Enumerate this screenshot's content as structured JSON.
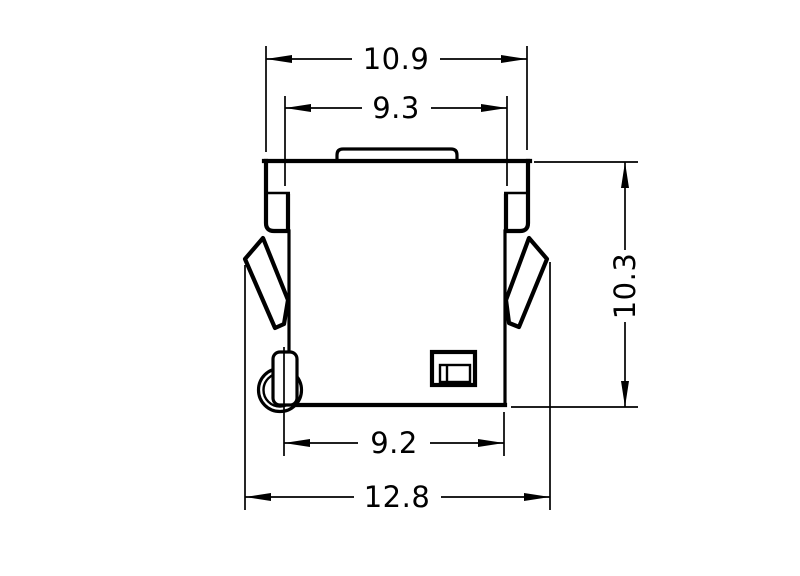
{
  "drawing": {
    "background": "#ffffff",
    "line_color": "#000000",
    "view": {
      "type": "dimensioned-outline-drawing",
      "units_shown": false
    },
    "dimensions": {
      "top_outer": "10.9",
      "top_inner": "9.3",
      "height_right": "10.3",
      "bottom_inner": "9.2",
      "bottom_outer": "12.8"
    }
  }
}
